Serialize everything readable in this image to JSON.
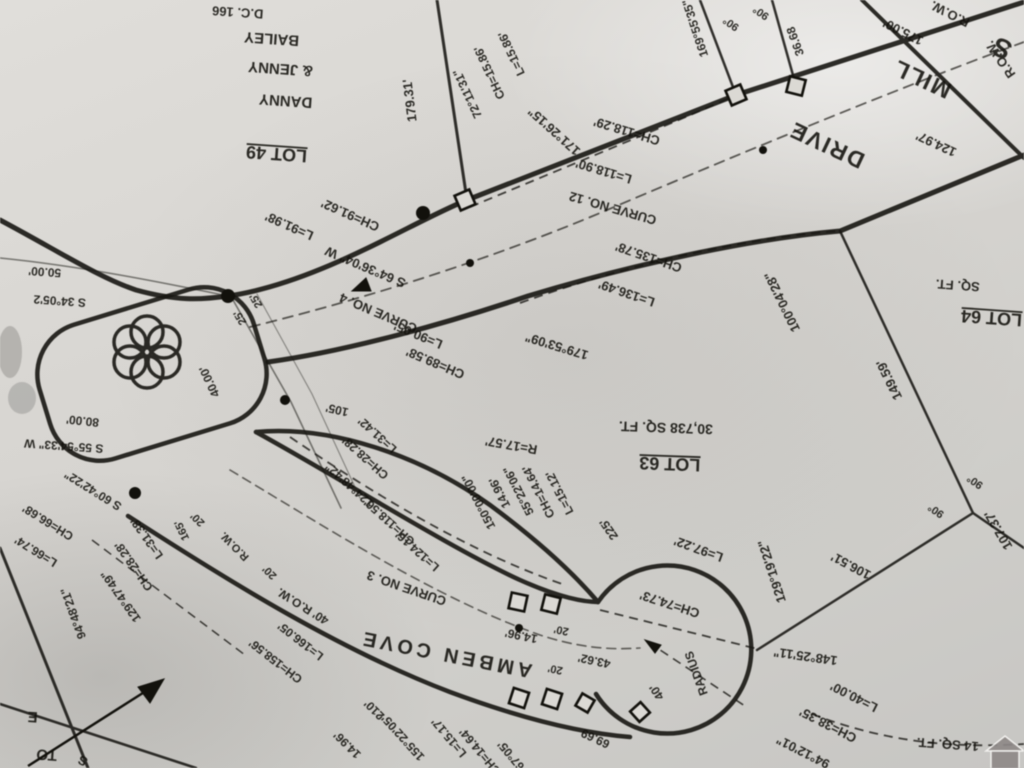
{
  "map": {
    "kind": "plat-survey-photo-rotated-180",
    "roads": [
      {
        "name": "MILL DRIVE",
        "row": "R.O.W."
      },
      {
        "name": "AMBEN COVE",
        "row": "40' R.O.W."
      }
    ],
    "lots": [
      {
        "id": "LOT 49",
        "owner": "DANNY & JENNY BAILEY"
      },
      {
        "id": "LOT 63",
        "area": "30,738 SQ. FT."
      },
      {
        "id": "LOT 64",
        "area": "SQ. FT."
      }
    ],
    "curves": [
      "CURVE NO. 3",
      "CURVE NO. 4",
      "CURVE NO. 12"
    ],
    "labels": [
      {
        "t": "D.C. 166",
        "x": 238,
        "y": 8,
        "r": 184,
        "s": 13
      },
      {
        "t": "BAILEY",
        "x": 272,
        "y": 34,
        "r": 184,
        "s": 15
      },
      {
        "t": "& JENNY",
        "x": 281,
        "y": 64,
        "r": 184,
        "s": 15
      },
      {
        "t": "DANNY",
        "x": 286,
        "y": 96,
        "r": 184,
        "s": 15
      },
      {
        "t": "LOT 49",
        "x": 277,
        "y": 148,
        "r": 184,
        "s": 18,
        "u": 1,
        "name": "label-lot-49"
      },
      {
        "t": "179.31'",
        "x": 414,
        "y": 100,
        "r": 263,
        "s": 13
      },
      {
        "t": "L=15.86'",
        "x": 515,
        "y": 52,
        "r": 245,
        "s": 12
      },
      {
        "t": "CH=15.86'",
        "x": 493,
        "y": 71,
        "r": 245,
        "s": 12
      },
      {
        "t": "72°11'31\"",
        "x": 471,
        "y": 92,
        "r": 245,
        "s": 12
      },
      {
        "t": "171°26'15\"",
        "x": 557,
        "y": 128,
        "r": 222,
        "s": 13
      },
      {
        "t": "CH=118.29'",
        "x": 628,
        "y": 127,
        "r": 197,
        "s": 13
      },
      {
        "t": "L=118.90'",
        "x": 605,
        "y": 167,
        "r": 197,
        "s": 13
      },
      {
        "t": "CURVE NO. 12",
        "x": 614,
        "y": 204,
        "r": 196,
        "s": 13,
        "name": "label-curve-12"
      },
      {
        "t": "169°55'35\"",
        "x": 699,
        "y": 27,
        "r": 252,
        "s": 12
      },
      {
        "t": "90°",
        "x": 733,
        "y": 21,
        "r": 215,
        "s": 11
      },
      {
        "t": "90°",
        "x": 763,
        "y": 10,
        "r": 215,
        "s": 11
      },
      {
        "t": "36.68",
        "x": 799,
        "y": 40,
        "r": 250,
        "s": 12
      },
      {
        "t": "175.00'",
        "x": 905,
        "y": 28,
        "r": 207,
        "s": 13
      },
      {
        "t": "R.O.W.",
        "x": 952,
        "y": 10,
        "r": 207,
        "s": 13
      },
      {
        "t": "R.O.W.",
        "x": 1004,
        "y": 57,
        "r": 235,
        "s": 13
      },
      {
        "t": "S",
        "x": 1006,
        "y": 40,
        "r": 205,
        "s": 27
      },
      {
        "t": "MILL",
        "x": 925,
        "y": 72,
        "r": 205,
        "s": 23,
        "ls": 2,
        "name": "label-road-mill-drive"
      },
      {
        "t": "DRIVE",
        "x": 830,
        "y": 138,
        "r": 205,
        "s": 23,
        "ls": 2
      },
      {
        "t": "124.97'",
        "x": 938,
        "y": 140,
        "r": 205,
        "s": 13
      },
      {
        "t": "L=91.98'",
        "x": 291,
        "y": 222,
        "r": 204,
        "s": 13
      },
      {
        "t": "CH=91.62'",
        "x": 352,
        "y": 211,
        "r": 204,
        "s": 13
      },
      {
        "t": "S 64°36'04\" W",
        "x": 367,
        "y": 263,
        "r": 203,
        "s": 13
      },
      {
        "t": "25'",
        "x": 243,
        "y": 316,
        "r": 240,
        "s": 11
      },
      {
        "t": "25'",
        "x": 259,
        "y": 299,
        "r": 240,
        "s": 11
      },
      {
        "t": "CURVE NO. 4",
        "x": 380,
        "y": 309,
        "r": 203,
        "s": 13,
        "name": "label-curve-4"
      },
      {
        "t": "L=90.05'",
        "x": 420,
        "y": 331,
        "r": 203,
        "s": 13
      },
      {
        "t": "CH=89.58'",
        "x": 437,
        "y": 359,
        "r": 203,
        "s": 13
      },
      {
        "t": "179°53'09\"",
        "x": 558,
        "y": 342,
        "r": 197,
        "s": 13
      },
      {
        "t": "CH=135.78'",
        "x": 650,
        "y": 253,
        "r": 199,
        "s": 13
      },
      {
        "t": "L=136.49'",
        "x": 628,
        "y": 289,
        "r": 199,
        "s": 13
      },
      {
        "t": "100°04'28\"",
        "x": 786,
        "y": 300,
        "r": 244,
        "s": 13
      },
      {
        "t": "149.59'",
        "x": 893,
        "y": 378,
        "r": 244,
        "s": 13
      },
      {
        "t": "SQ. FT.",
        "x": 958,
        "y": 281,
        "r": 184,
        "s": 13
      },
      {
        "t": "LOT 64",
        "x": 992,
        "y": 312,
        "r": 184,
        "s": 18,
        "u": 1,
        "name": "label-lot-64"
      },
      {
        "t": "50.00'",
        "x": 45,
        "y": 268,
        "r": 184,
        "s": 12
      },
      {
        "t": "S 34°05'2",
        "x": 60,
        "y": 297,
        "r": 184,
        "s": 12
      },
      {
        "t": "80.00'",
        "x": 83,
        "y": 417,
        "r": 186,
        "s": 12
      },
      {
        "t": "S 55°54'33\" W",
        "x": 64,
        "y": 442,
        "r": 184,
        "s": 12
      },
      {
        "t": "S 60°42'22\"",
        "x": 95,
        "y": 487,
        "r": 212,
        "s": 12
      },
      {
        "t": "CH=66.68'",
        "x": 50,
        "y": 519,
        "r": 212,
        "s": 12
      },
      {
        "t": "L=66.74'",
        "x": 38,
        "y": 548,
        "r": 212,
        "s": 12
      },
      {
        "t": "40.00'",
        "x": 213,
        "y": 380,
        "r": 245,
        "s": 12
      },
      {
        "t": "20'",
        "x": 200,
        "y": 517,
        "r": 225,
        "s": 11
      },
      {
        "t": "R.O.W.",
        "x": 237,
        "y": 544,
        "r": 225,
        "s": 11
      },
      {
        "t": "20'",
        "x": 272,
        "y": 570,
        "r": 225,
        "s": 11
      },
      {
        "t": "165'",
        "x": 185,
        "y": 529,
        "r": 245,
        "s": 11
      },
      {
        "t": "105'",
        "x": 338,
        "y": 406,
        "r": 193,
        "s": 12
      },
      {
        "t": "L=31.42'",
        "x": 380,
        "y": 432,
        "r": 222,
        "s": 12
      },
      {
        "t": "CH=28.28'",
        "x": 368,
        "y": 455,
        "r": 222,
        "s": 12
      },
      {
        "t": "124°48'42\"",
        "x": 352,
        "y": 482,
        "r": 222,
        "s": 12
      },
      {
        "t": "CH=118.56'",
        "x": 392,
        "y": 519,
        "r": 222,
        "s": 12
      },
      {
        "t": "L=124.16'",
        "x": 420,
        "y": 548,
        "r": 222,
        "s": 12
      },
      {
        "t": "R=17.57'",
        "x": 512,
        "y": 441,
        "r": 190,
        "s": 13
      },
      {
        "t": "150°00'00\"",
        "x": 482,
        "y": 500,
        "r": 243,
        "s": 12
      },
      {
        "t": "14.96'",
        "x": 503,
        "y": 491,
        "r": 243,
        "s": 12
      },
      {
        "t": "55°22'06\"",
        "x": 522,
        "y": 489,
        "r": 243,
        "s": 12
      },
      {
        "t": "CH=14.64'",
        "x": 542,
        "y": 490,
        "r": 243,
        "s": 12
      },
      {
        "t": "L=15.12'",
        "x": 563,
        "y": 491,
        "r": 243,
        "s": 12
      },
      {
        "t": "225'",
        "x": 612,
        "y": 527,
        "r": 235,
        "s": 12
      },
      {
        "t": "LOT 63",
        "x": 670,
        "y": 458,
        "r": 182,
        "s": 18,
        "u": 1,
        "name": "label-lot-63"
      },
      {
        "t": "30,738 SQ. FT.",
        "x": 666,
        "y": 423,
        "r": 182,
        "s": 14
      },
      {
        "t": "CURVE NO. 3",
        "x": 408,
        "y": 584,
        "r": 199,
        "s": 13,
        "name": "label-curve-3"
      },
      {
        "t": "40' R.O.W.",
        "x": 305,
        "y": 603,
        "r": 212,
        "s": 12
      },
      {
        "t": "AMBEN  COVE",
        "x": 447,
        "y": 648,
        "r": 191,
        "s": 20,
        "ls": 4,
        "name": "label-road-amben-cove"
      },
      {
        "t": "CH=158.56'",
        "x": 278,
        "y": 658,
        "r": 218,
        "s": 12
      },
      {
        "t": "L=166.05'",
        "x": 303,
        "y": 638,
        "r": 218,
        "s": 12
      },
      {
        "t": "210'",
        "x": 377,
        "y": 707,
        "r": 225,
        "s": 12
      },
      {
        "t": "14.96'",
        "x": 350,
        "y": 742,
        "r": 225,
        "s": 12
      },
      {
        "t": "155°22'05\"",
        "x": 405,
        "y": 734,
        "r": 228,
        "s": 12
      },
      {
        "t": "L=15.17'",
        "x": 452,
        "y": 735,
        "r": 230,
        "s": 12
      },
      {
        "t": "CH=14.64'",
        "x": 483,
        "y": 749,
        "r": 230,
        "s": 12
      },
      {
        "t": "67°05'",
        "x": 514,
        "y": 753,
        "r": 230,
        "s": 12
      },
      {
        "t": "14.96'",
        "x": 522,
        "y": 632,
        "r": 192,
        "s": 12
      },
      {
        "t": "20'",
        "x": 562,
        "y": 627,
        "r": 192,
        "s": 11
      },
      {
        "t": "20'",
        "x": 556,
        "y": 666,
        "r": 192,
        "s": 11
      },
      {
        "t": "43.62'",
        "x": 595,
        "y": 657,
        "r": 192,
        "s": 12
      },
      {
        "t": "69.69",
        "x": 597,
        "y": 735,
        "r": 205,
        "s": 12
      },
      {
        "t": "40'",
        "x": 660,
        "y": 690,
        "r": 237,
        "s": 12
      },
      {
        "t": "RADIUS",
        "x": 700,
        "y": 672,
        "r": 250,
        "s": 12
      },
      {
        "t": "L=97.22'",
        "x": 700,
        "y": 545,
        "r": 200,
        "s": 13
      },
      {
        "t": "CH=74.73'",
        "x": 671,
        "y": 600,
        "r": 198,
        "s": 13
      },
      {
        "t": "129°19'22\"",
        "x": 776,
        "y": 570,
        "r": 252,
        "s": 13
      },
      {
        "t": "106.51'",
        "x": 853,
        "y": 562,
        "r": 208,
        "s": 13
      },
      {
        "t": "148°25'11\"",
        "x": 806,
        "y": 652,
        "r": 188,
        "s": 13
      },
      {
        "t": "90°",
        "x": 938,
        "y": 508,
        "r": 215,
        "s": 11
      },
      {
        "t": "90°",
        "x": 977,
        "y": 479,
        "r": 215,
        "s": 11
      },
      {
        "t": "107.37'",
        "x": 1002,
        "y": 528,
        "r": 240,
        "s": 13
      },
      {
        "t": "L=40.00'",
        "x": 856,
        "y": 693,
        "r": 207,
        "s": 13
      },
      {
        "t": "CH=38.35'",
        "x": 830,
        "y": 721,
        "r": 207,
        "s": 13
      },
      {
        "t": "94°12'01\"",
        "x": 805,
        "y": 748,
        "r": 207,
        "s": 13
      },
      {
        "t": "14 SQ. FT.",
        "x": 948,
        "y": 740,
        "r": 184,
        "s": 13
      },
      {
        "t": "94°48'21\"",
        "x": 77,
        "y": 612,
        "r": 250,
        "s": 12
      },
      {
        "t": "L=31.38'",
        "x": 150,
        "y": 536,
        "r": 235,
        "s": 12
      },
      {
        "t": "CH=28.28'",
        "x": 137,
        "y": 564,
        "r": 235,
        "s": 12
      },
      {
        "t": "129°47'49\"",
        "x": 124,
        "y": 594,
        "r": 235,
        "s": 12
      },
      {
        "t": "E",
        "x": 33,
        "y": 712,
        "r": 184,
        "s": 15
      },
      {
        "t": "TO",
        "x": 47,
        "y": 750,
        "r": 184,
        "s": 15
      },
      {
        "t": "S",
        "x": 85,
        "y": 757,
        "r": 210,
        "s": 13
      }
    ]
  },
  "colors": {
    "paper": "#d6d4d0",
    "ink": "#17160f",
    "watermark": "#8d8887"
  }
}
